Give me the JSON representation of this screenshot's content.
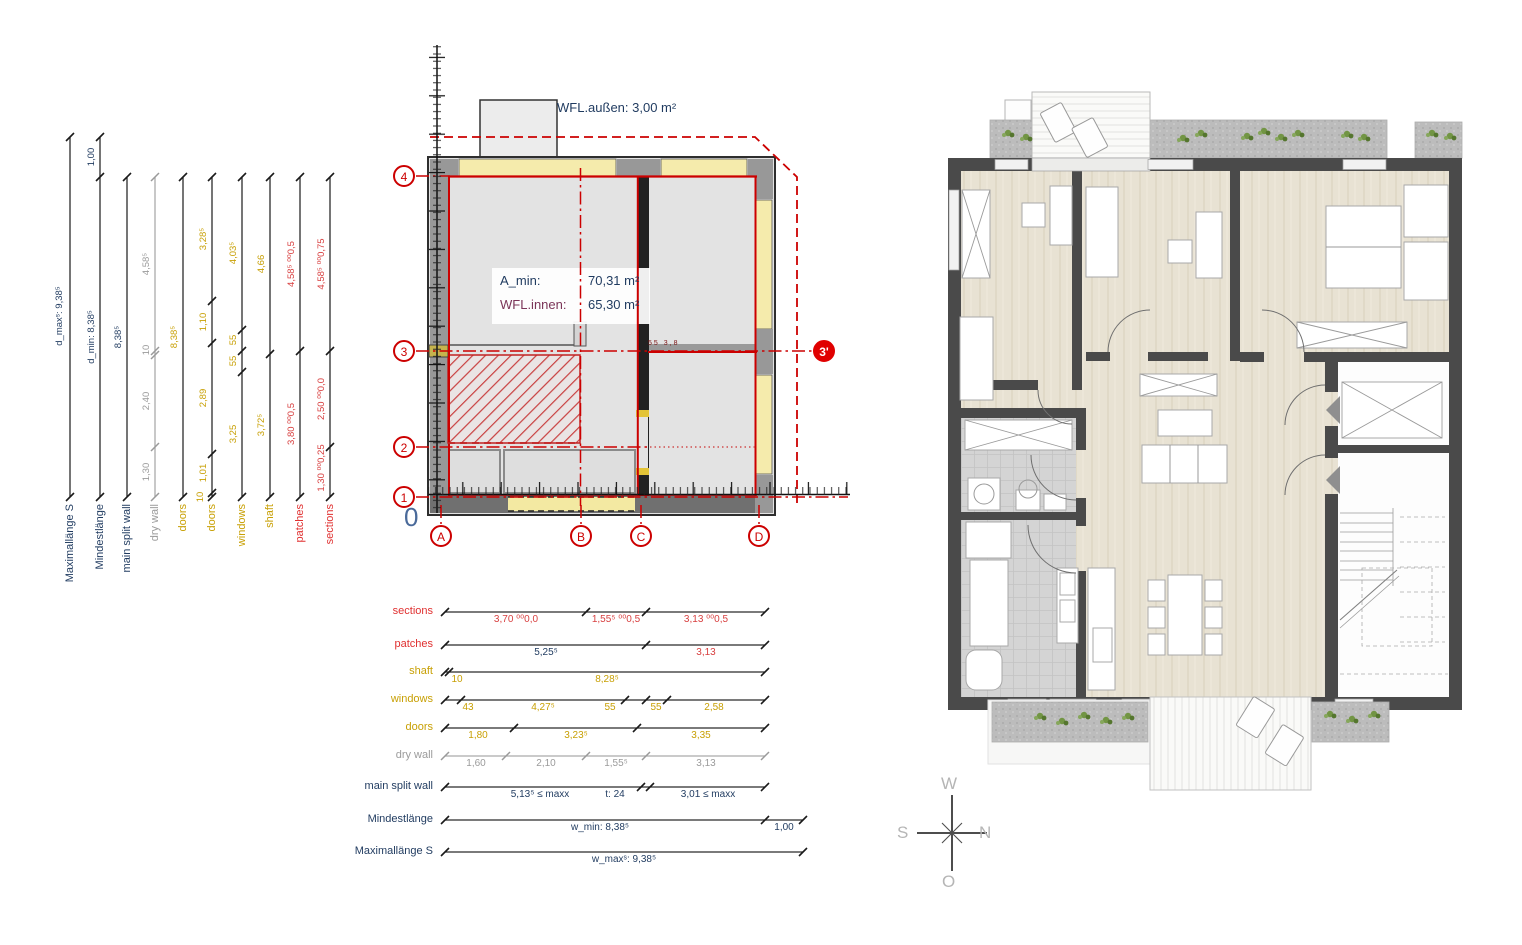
{
  "colors": {
    "accent_red": "#cc0000",
    "dim_navy": "#1f3a5f",
    "dim_yellow": "#c8a005",
    "dim_gray": "#9b9b9b",
    "window_band": "#f5ebac"
  },
  "left_dims": {
    "cols": [
      {
        "label": "Maximallänge S",
        "v0": "d_maxˢ: 9,38⁵"
      },
      {
        "label": "Mindestlänge",
        "v0": "1,00",
        "v1": "d_min: 8,38⁵"
      },
      {
        "label": "main split wall",
        "v0": "8,38⁵"
      },
      {
        "label": "dry wall",
        "v0": "4,58⁵",
        "v1": "10",
        "v2": "2,40",
        "v3": "1,30"
      },
      {
        "label": "doors",
        "v0": "8,38⁵"
      },
      {
        "label": "doors",
        "v0": "3,28⁵",
        "v1": "1,10",
        "v2": "2,89",
        "v3": "1,01",
        "v4": "10"
      },
      {
        "label": "windows",
        "v0": "4,03⁵",
        "v1": "55",
        "v2": "55",
        "v3": "3,25"
      },
      {
        "label": "shaft",
        "v0": "4,66",
        "v1": "3,72⁵"
      },
      {
        "label": "patches",
        "v0": "4,58⁵ ⁰⁰0,5",
        "v1": "3,80 ⁰⁰0,5"
      },
      {
        "label": "sections",
        "v0": "4,58⁵ ⁰⁰0,75",
        "v1": "2,50 ⁰⁰0,0",
        "v2": "1,30 ⁰⁰0,25"
      }
    ]
  },
  "bottom_dims": {
    "rows": [
      {
        "label": "sections",
        "v0": "3,70 ⁰⁰0,0",
        "v1": "1,55⁵ ⁰⁰0,5",
        "v2": "3,13 ⁰⁰0,5"
      },
      {
        "label": "patches",
        "v0": "5,25⁵",
        "v1": "3,13"
      },
      {
        "label": "shaft",
        "v0": "10",
        "v1": "8,28⁵"
      },
      {
        "label": "windows",
        "v0": "43",
        "v1": "4,27⁵",
        "v2": "55",
        "v3": "55",
        "v4": "2,58"
      },
      {
        "label": "doors",
        "v0": "1,80",
        "v1": "3,23⁵",
        "v2": "3,35"
      },
      {
        "label": "dry wall",
        "v0": "1,60",
        "v1": "2,10",
        "v2": "1,55⁵",
        "v3": "3,13"
      },
      {
        "label": "main split wall",
        "v0": "5,13⁵ ≤ maxx",
        "v1": "t: 24",
        "v2": "3,01 ≤ maxx"
      },
      {
        "label": "Mindestlänge",
        "v0": "w_min: 8,38⁵",
        "v1": "1,00"
      },
      {
        "label": "Maximallänge S",
        "v0": "w_maxˢ: 9,38⁵"
      }
    ]
  },
  "plan": {
    "wfl_aussen": "WFL.außen: 3,00 m²",
    "amin_label": "A_min:",
    "amin_value": "70,31 m²",
    "wfl_innen_label": "WFL.innen:",
    "wfl_innen_value": "65,30 m²",
    "origin": "0",
    "line3_note": "55  3,8",
    "grid": {
      "r1": "1",
      "r2": "2",
      "r3": "3",
      "r4": "4",
      "r3p": "3'",
      "cA": "A",
      "cB": "B",
      "cC": "C",
      "cD": "D"
    }
  },
  "compass": {
    "top": "W",
    "left": "S",
    "right": "N",
    "bottom": "O"
  }
}
